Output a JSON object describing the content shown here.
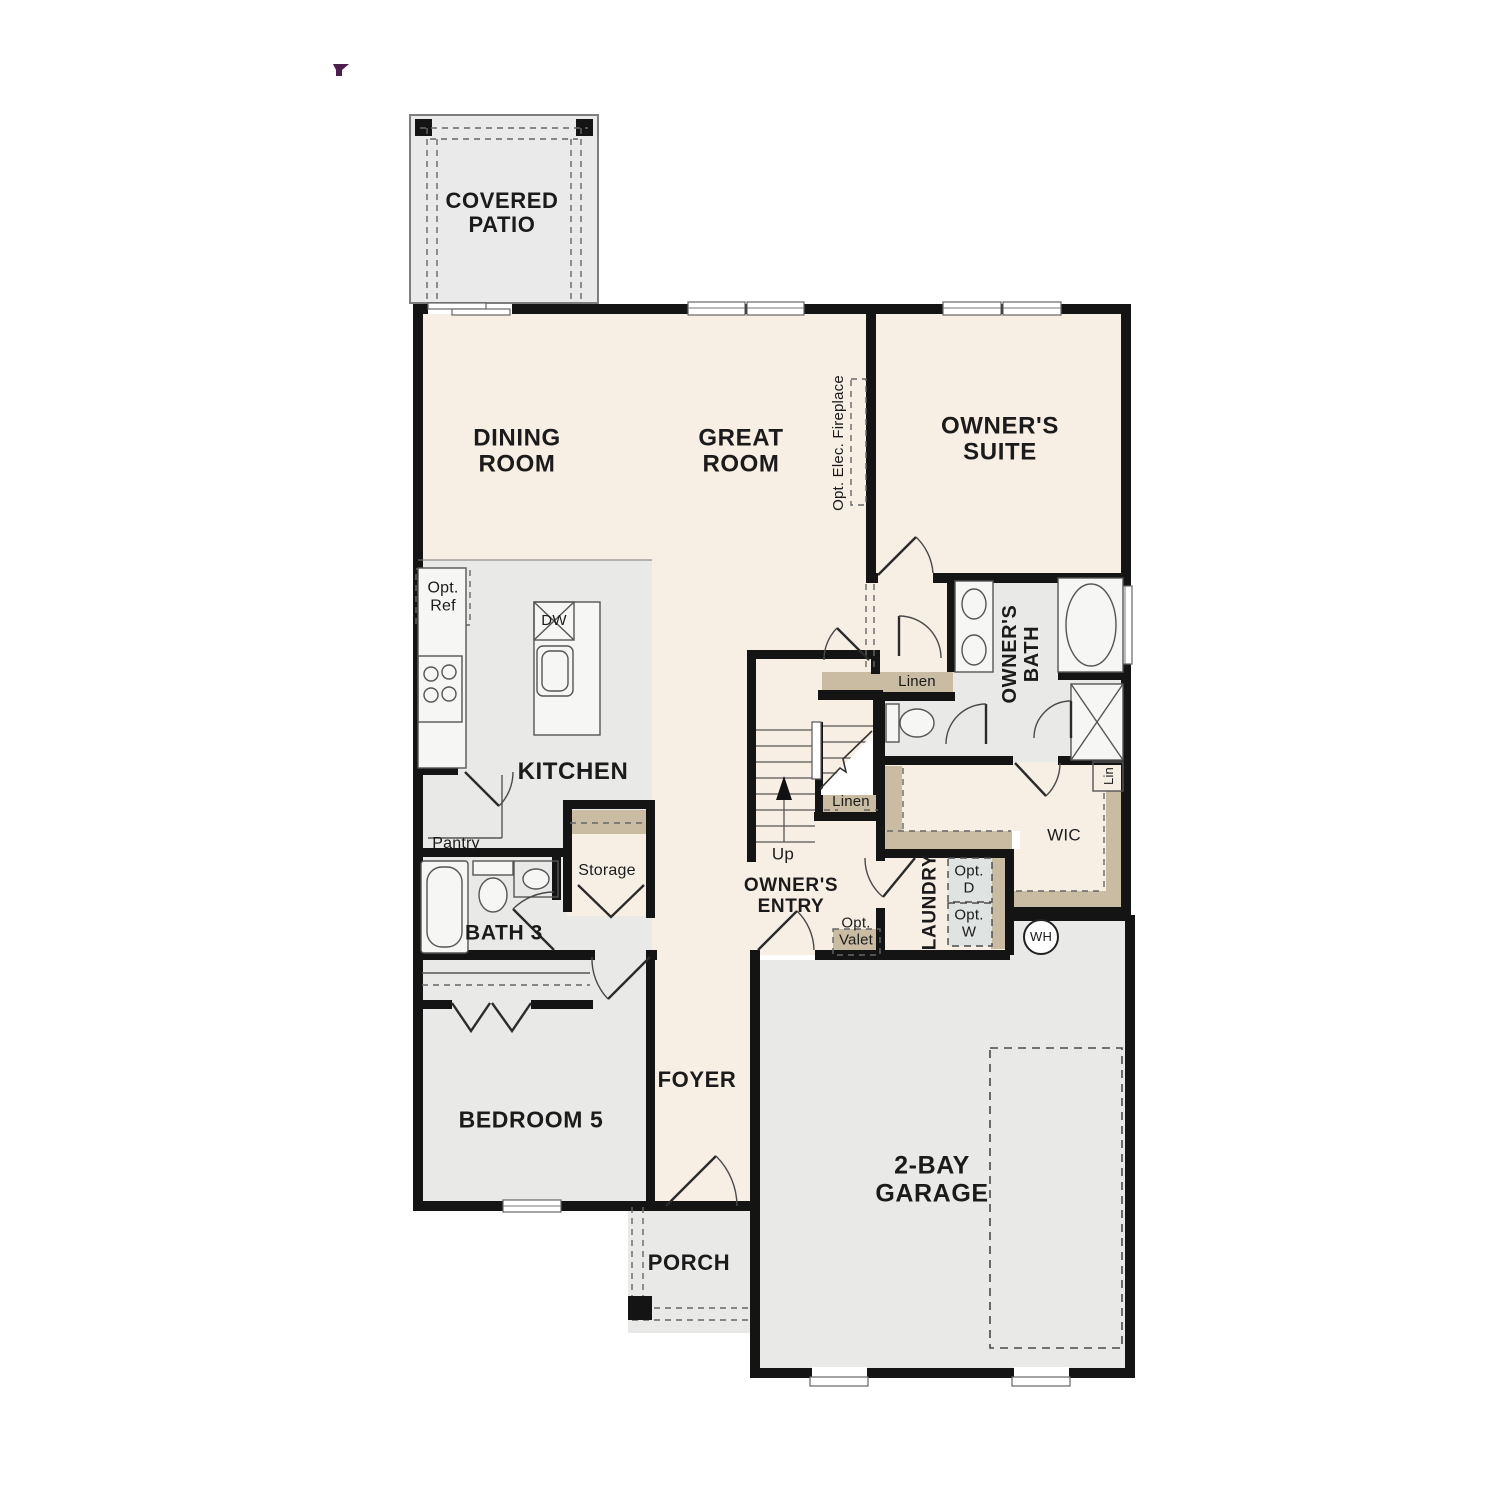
{
  "plan": {
    "title": "single-story floor plan",
    "floor_count_visible": 1
  },
  "colors": {
    "floor_cream": "#f8efe4",
    "floor_gray": "#e9e9e7",
    "patio_gray": "#eaeaea",
    "shelf_tan": "#c9bca3",
    "wall": "#141414",
    "line": "#4a4a4a",
    "opt_box": "#dfe3e1",
    "accent": "#4b1e4d",
    "fixture": "#f6f6f4"
  },
  "labels": {
    "covered_patio": "COVERED\nPATIO",
    "dining": "DINING\nROOM",
    "great": "GREAT\nROOM",
    "fireplace": "Opt. Elec. Fireplace",
    "owners_suite": "OWNER'S\nSUITE",
    "opt_ref": "Opt.\nRef",
    "dw": "DW",
    "kitchen": "KITCHEN",
    "pantry": "Pantry",
    "storage": "Storage",
    "bath3": "BATH 3",
    "bedroom5": "BEDROOM 5",
    "foyer": "FOYER",
    "porch": "PORCH",
    "garage": "2-BAY\nGARAGE",
    "owners_entry": "OWNER'S\nENTRY",
    "up": "Up",
    "linen_hall": "Linen",
    "linen_stairs": "Linen",
    "owners_bath": "OWNER'S\nBATH",
    "lin": "Lin",
    "wic": "WIC",
    "laundry": "LAUNDRY",
    "opt_d": "Opt.\nD",
    "opt_w": "Opt.\nW",
    "opt_valet": "Opt.\nValet",
    "wh": "WH"
  },
  "icons": {
    "pointer_glyph": "purple pointer mark (top-left)",
    "water_heater": "WH circle",
    "dishwasher": "DW crossed box",
    "range": "4-burner cooktop",
    "up_arrow": "stair direction arrow"
  }
}
